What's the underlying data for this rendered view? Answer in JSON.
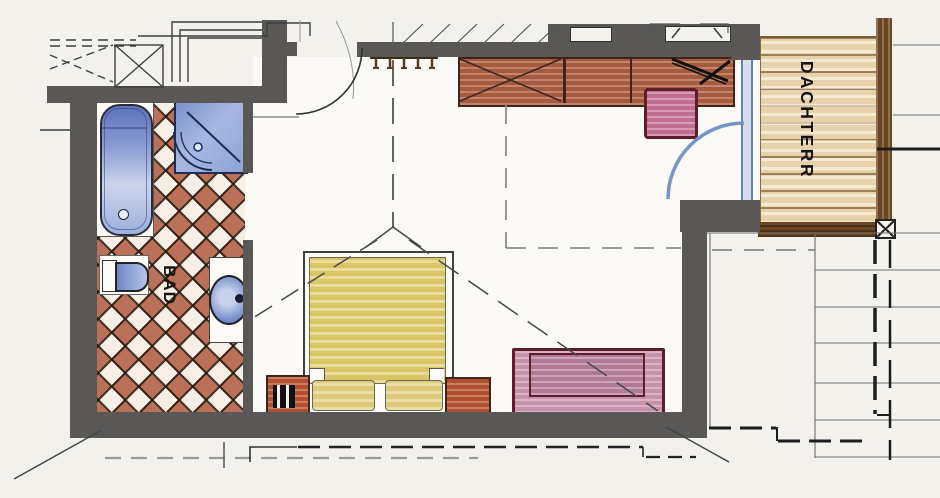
{
  "plan": {
    "labels": {
      "bathroom": "BAD",
      "terrace": "DACHTERR"
    },
    "colors": {
      "wall": "#5a5856",
      "tile_terracotta": "#b5664c",
      "sanitary_blue": "#5b76c0",
      "furniture_wood_red": "#a65a3e",
      "bed_yellow": "#d9c566",
      "sofa_pink": "#c792ab",
      "deck_tan": "#e6d3ab",
      "railing_brown": "#6a4724",
      "door_swing_blue": "#7695c5"
    },
    "rooms": [
      {
        "name": "bathroom",
        "fixtures": [
          "bathtub",
          "corner-shower",
          "toilet",
          "washbasin",
          "tiled-floor"
        ]
      },
      {
        "name": "bedroom",
        "fixtures": [
          "double-bed",
          "pillows",
          "nightstand-left",
          "nightstand-right",
          "wardrobe",
          "desk",
          "chair",
          "sofa-bench",
          "coat-hooks",
          "entry-door",
          "terrace-door"
        ]
      },
      {
        "name": "roof-terrace",
        "fixtures": [
          "wood-deck",
          "railing"
        ]
      }
    ]
  }
}
